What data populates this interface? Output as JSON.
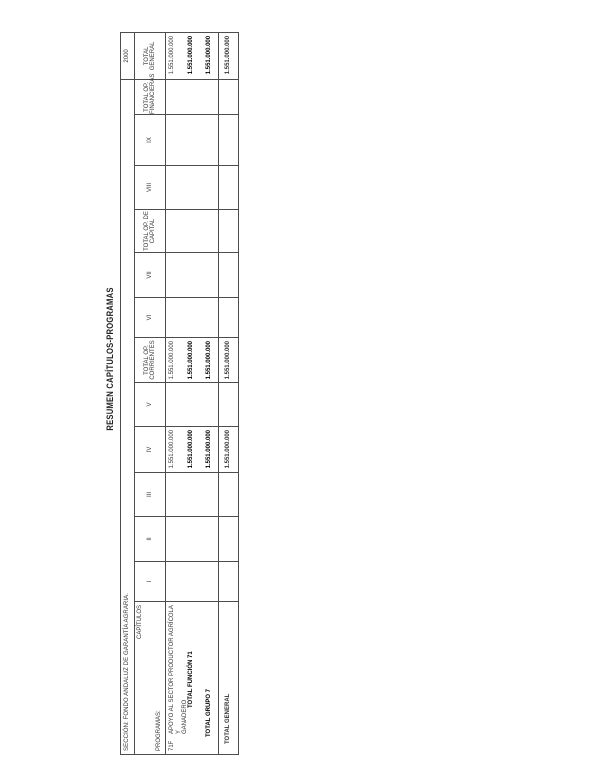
{
  "document": {
    "title": "RESUMEN CAPÍTULOS-PROGRAMAS",
    "year": "2000",
    "section_line": "SECCIÓN: FONDO ANDALUZ DE GARANTÍA AGRARIA.",
    "corner": {
      "capitulos": "CAPÍTULOS",
      "programas": "PROGRAMAS:"
    }
  },
  "table": {
    "column_headers": [
      {
        "label": "I"
      },
      {
        "label": "II"
      },
      {
        "label": "III"
      },
      {
        "label": "IV"
      },
      {
        "label": "V"
      },
      {
        "label": "TOTAL OP.\nCORRIENTES"
      },
      {
        "label": "VI"
      },
      {
        "label": "VII"
      },
      {
        "label": "TOTAL OP. DE\nCAPITAL"
      },
      {
        "label": "VIII"
      },
      {
        "label": "IX"
      },
      {
        "label": "TOTAL OP.\nFINANCIERAS"
      },
      {
        "label": "TOTAL\nGENERAL"
      }
    ],
    "rows": [
      {
        "code": "71F",
        "label": "APOYO AL SECTOR PRODUCTOR AGRÍCOLA Y\nGANADERO",
        "iv": "1.551.000.000",
        "total_op_corrientes": "1.551.000.000",
        "total_general": "1.551.000.000"
      },
      {
        "label": "TOTAL FUNCIÓN 71",
        "iv": "1.551.000.000",
        "total_op_corrientes": "1.551.000.000",
        "total_general": "1.551.000.000"
      },
      {
        "label": "TOTAL GRUPO 7",
        "iv": "1.551.000.000",
        "total_op_corrientes": "1.551.000.000",
        "total_general": "1.551.000.000"
      }
    ],
    "grand_total": {
      "label": "TOTAL GENERAL",
      "iv": "1.551.000.000",
      "total_op_corrientes": "1.551.000.000",
      "total_general": "1.551.000.000"
    }
  }
}
